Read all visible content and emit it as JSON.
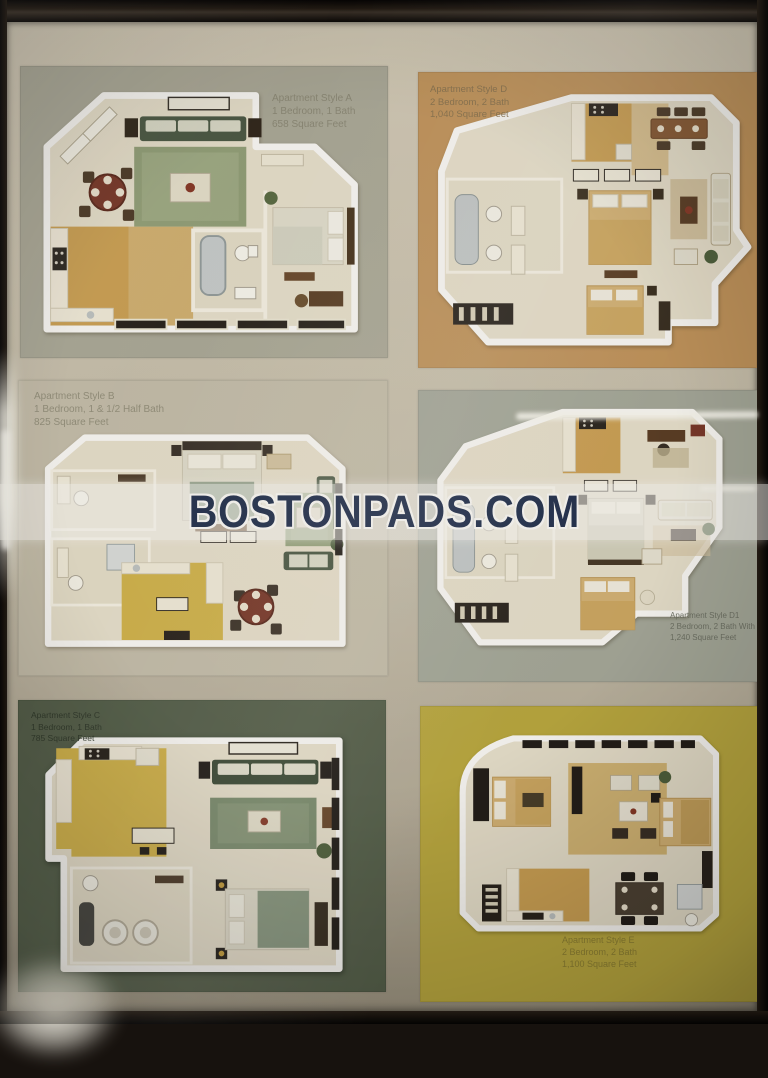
{
  "watermark": {
    "text": "BOSTONPADS.COM",
    "text_color": "#22304f",
    "band_color": "rgba(255,255,255,0.55)"
  },
  "frame": {
    "frame_color": "#17120e",
    "mat_color": "#c7c0ae"
  },
  "panels": [
    {
      "style": "A",
      "background": "#afae9e",
      "label_color": "#8e8c7a",
      "label_position": "top-right",
      "lines": [
        "Apartment Style A",
        "1 Bedroom, 1 Bath",
        "658 Square Feet"
      ]
    },
    {
      "style": "D",
      "background": "#c5985f",
      "label_color": "#8a7450",
      "label_position": "top-left",
      "lines": [
        "Apartment Style D",
        "2 Bedroom, 2 Bath",
        "1,040 Square Feet"
      ]
    },
    {
      "style": "B",
      "background": "#c9c3b1",
      "label_color": "#94917e",
      "label_position": "top-left",
      "lines": [
        "Apartment Style B",
        "1 Bedroom, 1 & 1/2 Half Bath",
        "825 Square Feet"
      ]
    },
    {
      "style": "D1",
      "background": "#a9ada0",
      "label_color": "#6d7165",
      "label_position": "bottom-right",
      "lines": [
        "Apartment Style D1",
        "2 Bedroom, 2 Bath With Flex Space",
        "1,240 Square Feet"
      ]
    },
    {
      "style": "C",
      "background": "#57624d",
      "label_color": "#30392b",
      "label_position": "top-left",
      "lines": [
        "Apartment Style C",
        "1 Bedroom, 1 Bath",
        "785 Square Feet"
      ]
    },
    {
      "style": "E",
      "background": "#bead42",
      "label_color": "#8d8133",
      "label_position": "bottom-center",
      "lines": [
        "Apartment Style E",
        "2 Bedroom, 2 Bath",
        "1,100 Square Feet"
      ]
    }
  ]
}
